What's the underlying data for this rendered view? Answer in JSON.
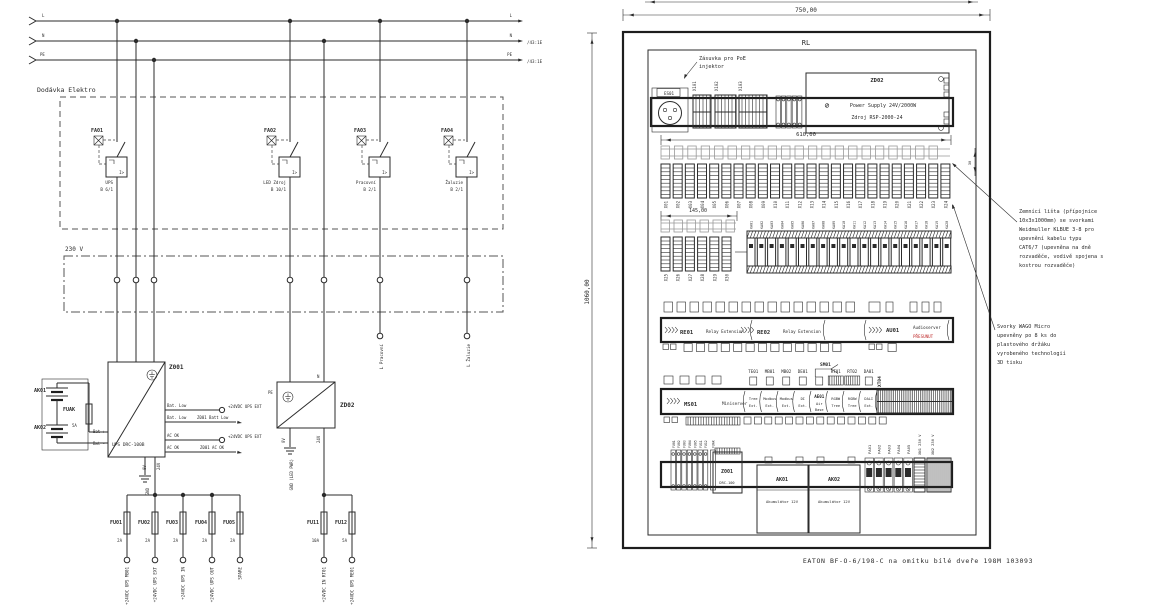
{
  "colors": {
    "line": "#2b2b2b",
    "red_note": "#c03030"
  },
  "schematic": {
    "bus": {
      "l": "L",
      "n": "N",
      "pe": "PE",
      "n_ref": "/43:1E",
      "pe_ref": "/43:1E"
    },
    "supply_box": "Dodávka Elektro",
    "voltage_box": "230 V",
    "breakers": [
      {
        "id": "FA01",
        "name": "UPS",
        "rating": "B 6/1"
      },
      {
        "id": "FA02",
        "name": "LED Zdroj",
        "rating": "B 10/1"
      },
      {
        "id": "FA03",
        "name": "Pracovní",
        "rating": "B 2/1"
      },
      {
        "id": "FA04",
        "name": "Žaluzie",
        "rating": "B 2/1"
      }
    ],
    "ups": {
      "id": "Z001",
      "model": "UPS DRC-100B",
      "bat_plus": "Bat +",
      "bat_minus": "Bat -",
      "bat_low": "Bat. Low",
      "ac_ok": "AC OK",
      "term_ext": "+24VDC UPS EXT",
      "ref_bat_low": "Z001 Batt Low",
      "ref_ac_ok": "Z001 AC OK",
      "v0": "0V",
      "v24": "24V",
      "gnd": "GND"
    },
    "battery": {
      "ak1": "AK01",
      "ak2": "AK02",
      "fuse": "FUAK",
      "rating": "5A"
    },
    "led_psu": {
      "id": "ZD02",
      "pe": "PE",
      "n": "N",
      "v0": "0V",
      "v24": "24V",
      "gnd": "GND (LED PWR)"
    },
    "fuses": [
      {
        "id": "FU01",
        "rating": "2A",
        "wire": "+24VDC UPS MB01"
      },
      {
        "id": "FU02",
        "rating": "2A",
        "wire": "+24VDC UPS EXT"
      },
      {
        "id": "FU03",
        "rating": "2A",
        "wire": "+24VDC UPS IN"
      },
      {
        "id": "FU04",
        "rating": "2A",
        "wire": "+24VDC UPS OUT"
      },
      {
        "id": "FU05",
        "rating": "2A",
        "wire": "SPARE"
      },
      {
        "id": "FU11",
        "rating": "10A",
        "wire": "+24VDC IN RT01"
      },
      {
        "id": "FU12",
        "rating": "5A",
        "wire": "+24VDC UPS ME01"
      }
    ],
    "outputs": [
      {
        "label": "L Pracovní"
      },
      {
        "label": "L Žaluzie"
      }
    ]
  },
  "panel": {
    "title": "RL",
    "dim_width": "750,00",
    "dim_height": "1060,00",
    "dim_rail": "610,00",
    "dim_rail2": "145,00",
    "dim_small": "30",
    "poe_note": [
      "Zásuvka pro PoE",
      "injektor"
    ],
    "socket": "ES01",
    "keystones": [
      "X101",
      "X102",
      "X103"
    ],
    "psu": {
      "id": "ZD02",
      "line1": "Power Supply 24V/2000W",
      "line2": "Zdroj RSP-2000-24"
    },
    "terminals": [
      "X01",
      "X02",
      "X03",
      "X04",
      "X05",
      "X06",
      "X07",
      "X08",
      "X09",
      "X10",
      "X11",
      "X12",
      "X13",
      "X14",
      "X15",
      "X16",
      "X17",
      "X18",
      "X19",
      "X20",
      "X21",
      "X22",
      "X23",
      "X24"
    ],
    "terminals2": [
      "X25",
      "X26",
      "X27",
      "X28",
      "X29",
      "X30"
    ],
    "relays": [
      "KA01",
      "KA02",
      "KA03",
      "KA04",
      "KA05",
      "KA06",
      "KA07",
      "KA08",
      "KA09",
      "KA10",
      "KA11",
      "KA12",
      "KA13",
      "KA14",
      "KA15",
      "KA16",
      "KA17",
      "KA18",
      "KA19",
      "KA20"
    ],
    "relay_row": {
      "re1": "RE01",
      "re1_name": "Relay Extension",
      "re2": "RE02",
      "re2_name": "Relay Extension",
      "au": "AU01",
      "au_name": "Audioserver",
      "au_note": "PŘESUNUT"
    },
    "server_row": {
      "ms": "MS01",
      "ms_name": "Miniserver",
      "top_labels": [
        "TE01",
        "MB01",
        "MB02",
        "DE01",
        "SM01",
        "RT01",
        "RT02",
        "DA01"
      ],
      "modules": [
        "Tree Ext.",
        "Modbus Ext.",
        "Modbus Ext.",
        "DI Ext.",
        "AE01 Air Base",
        "RGBW Tree",
        "RGBW Tree",
        "DALI Ext."
      ],
      "xt": "XT04"
    },
    "bottom": {
      "fuses": [
        "FU01",
        "FU02",
        "FU03",
        "FU04",
        "FU05",
        "FU11",
        "FU12"
      ],
      "fuak": "FUAK",
      "ups": "Z001",
      "ups_model": "DRC-100",
      "ak1": "AK01",
      "ak2": "AK02",
      "ak_name": "Akumulátor 12V",
      "breakers": [
        "FA01",
        "FA02",
        "FA03",
        "FA04",
        "FA05"
      ],
      "xn1": "XN1 230 V",
      "xn2": "XN2 230 V"
    },
    "annotation1": [
      "Zemnící lišta (přípojnice",
      "10x3x1000mm) se svorkami",
      "Weidmuller KLBUE 3-8 pro",
      "upevnění kabelu typu",
      "CAT6/7 (upevněna na dně",
      "rozvaděče, vodivě spojena s",
      "kostrou rozvaděče)"
    ],
    "annotation2": [
      "Svorky WAGO Micro",
      "upevněny po 8 ks do",
      "plastového držáku",
      "vyrobeného technologií",
      "3D tisku"
    ],
    "footer": "EATON BF-O-6/198-C na omítku bílé dveře 198M 103093"
  }
}
